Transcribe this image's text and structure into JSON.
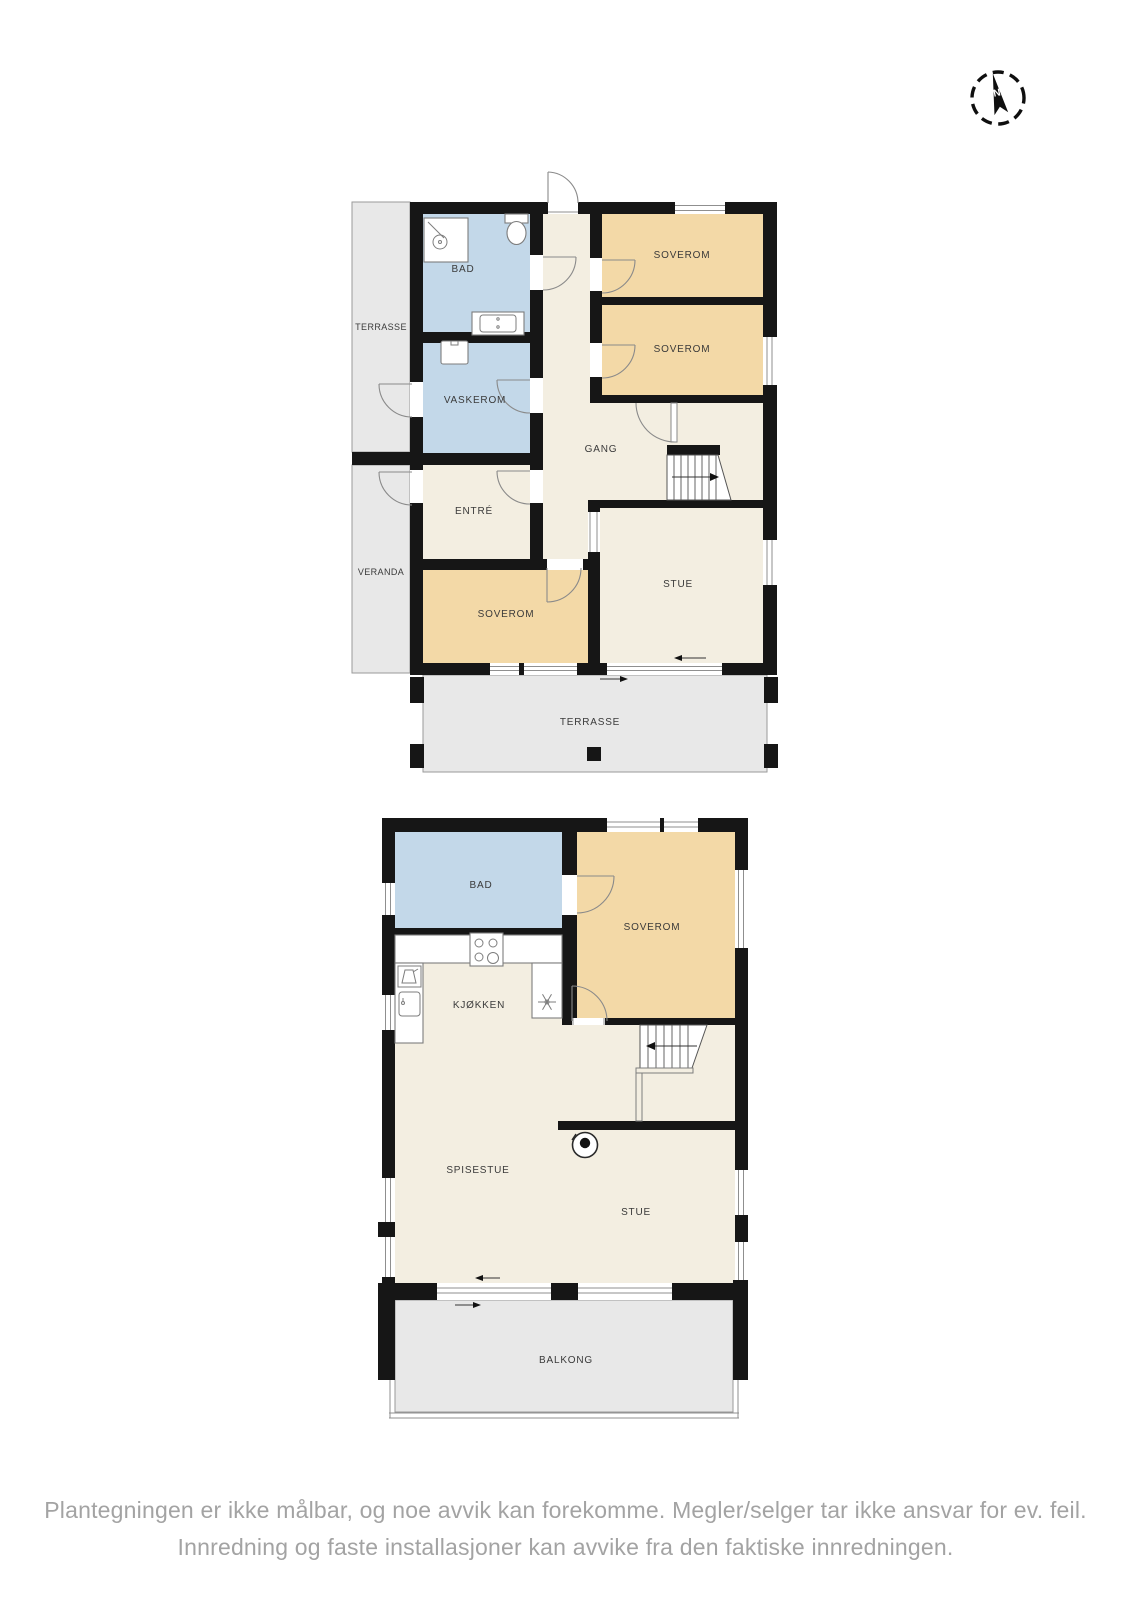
{
  "page": {
    "background": "#ffffff"
  },
  "compass": {
    "north_label": "N"
  },
  "floor1": {
    "rooms": {
      "terrasse_left": "TERRASSE",
      "bad": "BAD",
      "vaskerom": "VASKEROM",
      "soverom_1": "SOVEROM",
      "soverom_2": "SOVEROM",
      "gang": "GANG",
      "entre": "ENTRÉ",
      "veranda": "VERANDA",
      "soverom_3": "SOVEROM",
      "stue": "STUE",
      "terrasse": "TERRASSE"
    }
  },
  "floor2": {
    "rooms": {
      "bad": "BAD",
      "soverom": "SOVEROM",
      "kjokken": "KJØKKEN",
      "spisestue": "SPISESTUE",
      "stue": "STUE",
      "balkong": "BALKONG"
    }
  },
  "disclaimer": {
    "line1": "Plantegningen er ikke målbar, og noe avvik kan forekomme. Megler/selger tar ikke ansvar for ev. feil.",
    "line2": "Innredning og faste installasjoner kan avvike fra den faktiske innredningen."
  },
  "colors": {
    "wall": "#161616",
    "floor": "#f3eee1",
    "bedroom": "#f3d9a7",
    "wet_room": "#c3d8e9",
    "outdoor": "#e8e8e8",
    "label_text": "#3a3a3a",
    "disclaimer_text": "#a3a3a3"
  }
}
